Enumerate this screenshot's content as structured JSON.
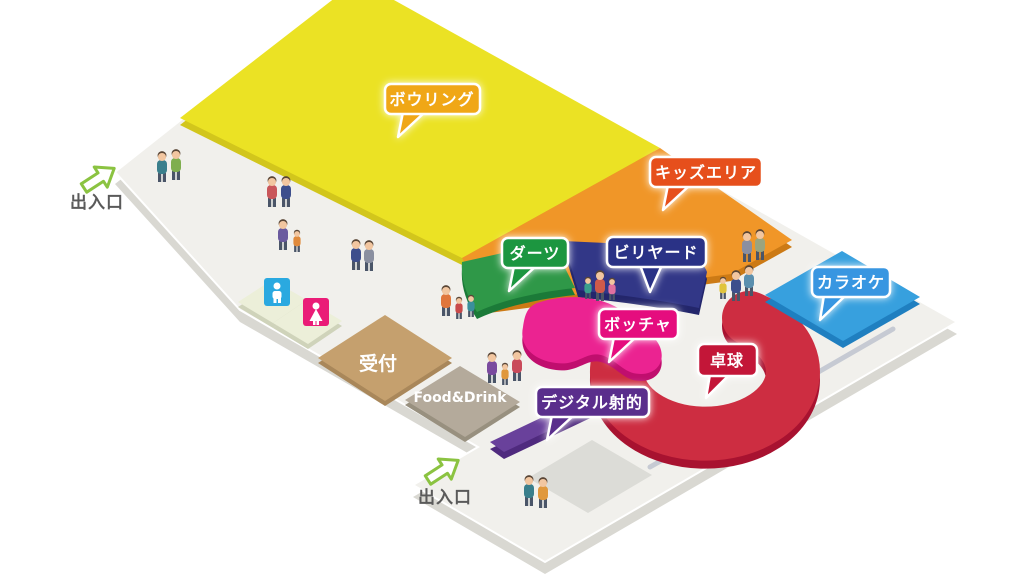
{
  "floor_map": {
    "areas": [
      {
        "id": "bowling",
        "label": "ボウリング",
        "bubble_color": "#f0a718",
        "area_color": "#ebe224"
      },
      {
        "id": "kids-area",
        "label": "キッズエリア",
        "bubble_color": "#e6501a",
        "area_color": "#f09628"
      },
      {
        "id": "darts",
        "label": "ダーツ",
        "bubble_color": "#1e9640",
        "area_color": "#2f9848"
      },
      {
        "id": "billiards",
        "label": "ビリヤード",
        "bubble_color": "#2c3086",
        "area_color": "#323787"
      },
      {
        "id": "karaoke",
        "label": "カラオケ",
        "bubble_color": "#3796e1",
        "area_color": "#37a0de"
      },
      {
        "id": "boccia",
        "label": "ボッチャ",
        "bubble_color": "#e5077e",
        "area_color": "#eb2391"
      },
      {
        "id": "table-tennis",
        "label": "卓球",
        "bubble_color": "#c31437",
        "area_color": "#cd2d41"
      },
      {
        "id": "digital-shooting",
        "label": "デジタル射的",
        "bubble_color": "#5a2d8c",
        "area_color": "#69419b"
      }
    ],
    "facilities": {
      "reception": {
        "label": "受付",
        "color": "#c5a06e"
      },
      "food_drink": {
        "label": "Food&Drink",
        "color": "#b4aa9b"
      },
      "restrooms": {
        "male_icon": "male-restroom-icon",
        "male_color": "#2aa9e0",
        "female_icon": "female-restroom-icon",
        "female_color": "#ea1c77"
      }
    },
    "entrances": [
      {
        "label": "出入口",
        "position": "upper-left"
      },
      {
        "label": "出入口",
        "position": "lower-center"
      }
    ],
    "arrow_color": "#8bc341",
    "floor_color": "#f1f0ec"
  }
}
